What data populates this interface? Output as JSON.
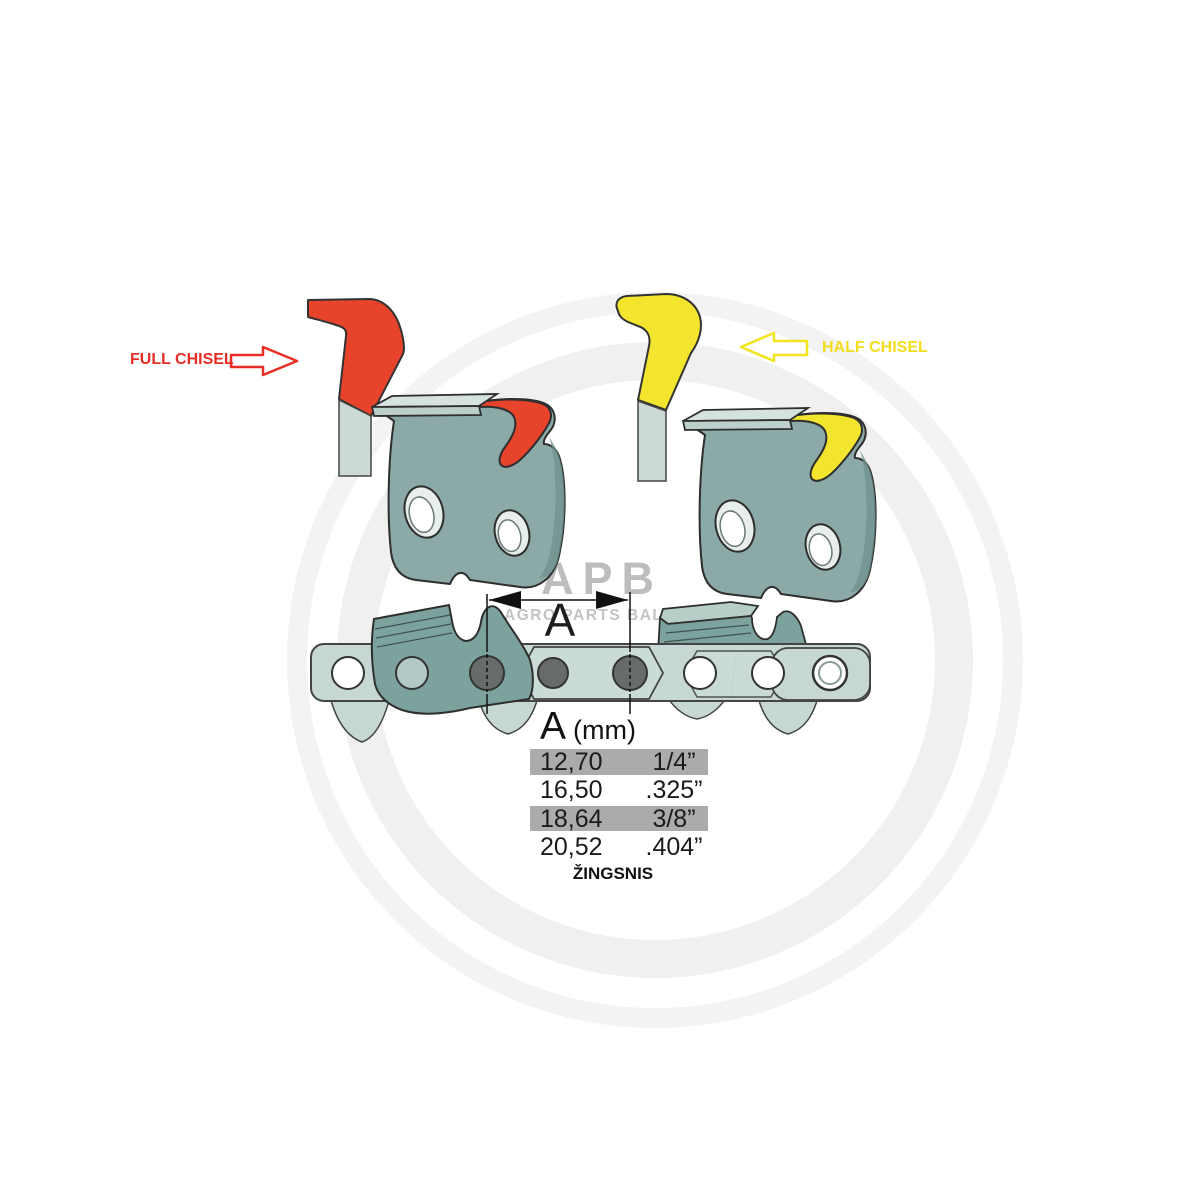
{
  "annotations": {
    "full_chisel": {
      "label": "FULL CHISEL",
      "color": "#e62e24",
      "arrow_direction": "right"
    },
    "half_chisel": {
      "label": "HALF CHISEL",
      "color": "#f2e41c",
      "arrow_direction": "left"
    }
  },
  "dimension": {
    "label": "A"
  },
  "pitch_table": {
    "header": {
      "symbol": "A",
      "unit": "(mm)"
    },
    "rows": [
      {
        "mm": "12,70",
        "inch": "1/4”",
        "highlighted": true
      },
      {
        "mm": "16,50",
        "inch": ".325”",
        "highlighted": false
      },
      {
        "mm": "18,64",
        "inch": "3/8”",
        "highlighted": true
      },
      {
        "mm": "20,52",
        "inch": ".404”",
        "highlighted": false
      }
    ],
    "caption": "ŽINGSNIS",
    "highlight_color": "#ababab"
  },
  "watermark": {
    "logo": "APB",
    "subtitle": "AGRO PARTS BALTIJA"
  },
  "colors": {
    "full_chisel_red": "#e8432b",
    "half_chisel_yellow": "#f3e52e",
    "cutter_body_teal": "#8ba9a6",
    "chain_link_teal": "#c7d8d4",
    "chain_cutter_teal": "#7ca29e",
    "rivet_dark_gray": "#676c6b",
    "table_highlight_gray": "#ababab",
    "watermark_gray": "#bdbdbd"
  }
}
